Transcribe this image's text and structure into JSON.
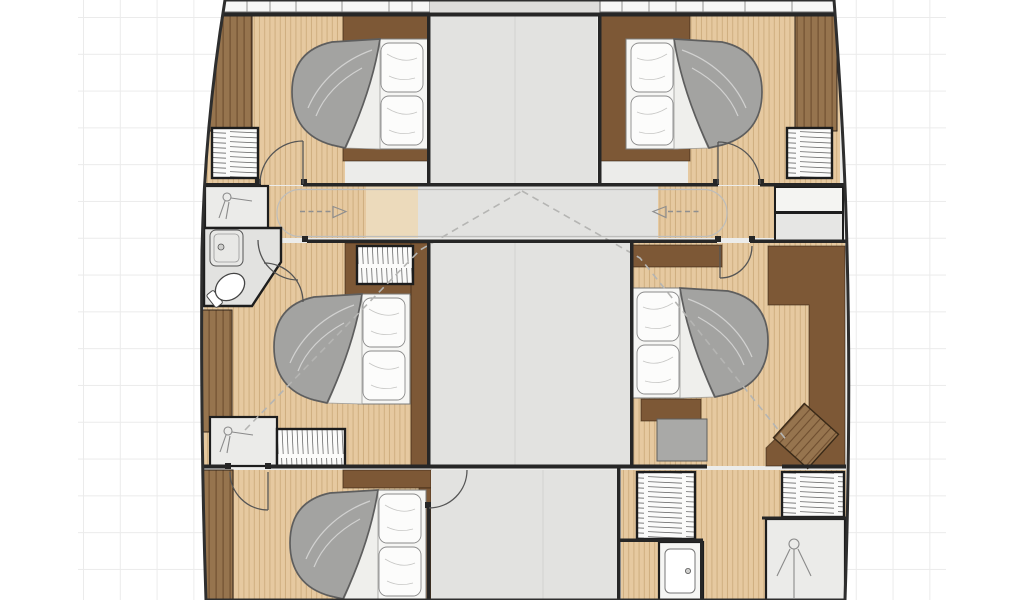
{
  "document": {
    "title": "Catamaran yacht cabin-deck floor plan"
  },
  "colors": {
    "bg": "#ffffff",
    "gridLine": "#ebebeb",
    "hullFill": "#ececea",
    "wall": "#262626",
    "wood": "#e6c9a0",
    "woodStripe": "#cfae80",
    "woodFlat": "#ecdabb",
    "panel": "#7d5836",
    "panelLight": "#96744e",
    "grainDark": "#6b4a2c",
    "floorGray": "#e2e2e0",
    "fixture": "#ebebe9",
    "duvet": "#a3a3a1",
    "duvetLine": "#5e5e5e",
    "seat": "#a9a9a7",
    "dash": "#b5b5b3",
    "arrow": "#8f8f8f",
    "arc": "#555555"
  },
  "plan": {
    "vessel": "catamaran lower deck",
    "rooms": [
      {
        "id": "cabin-fore-left",
        "type": "double-cabin"
      },
      {
        "id": "cabin-fore-right",
        "type": "double-cabin"
      },
      {
        "id": "corridor-athwartship",
        "type": "passage"
      },
      {
        "id": "bathroom-left",
        "type": "head"
      },
      {
        "id": "cabin-mid-left",
        "type": "double-cabin"
      },
      {
        "id": "cabin-mid-right",
        "type": "double-cabin"
      },
      {
        "id": "cabin-aft-left",
        "type": "double-cabin"
      },
      {
        "id": "utility-aft-right",
        "type": "head-with-wardrobes"
      },
      {
        "id": "saloon-center",
        "type": "open-floor"
      }
    ],
    "furniture": {
      "beds": 5,
      "wardrobes": 6,
      "shelf_units": 2,
      "showers": 3,
      "sinks": 2,
      "toilets": 1,
      "seats": 2,
      "doors": 7
    },
    "arrows": [
      {
        "id": "walkway-arrow-left",
        "direction": "right"
      },
      {
        "id": "walkway-arrow-right",
        "direction": "left"
      }
    ]
  }
}
